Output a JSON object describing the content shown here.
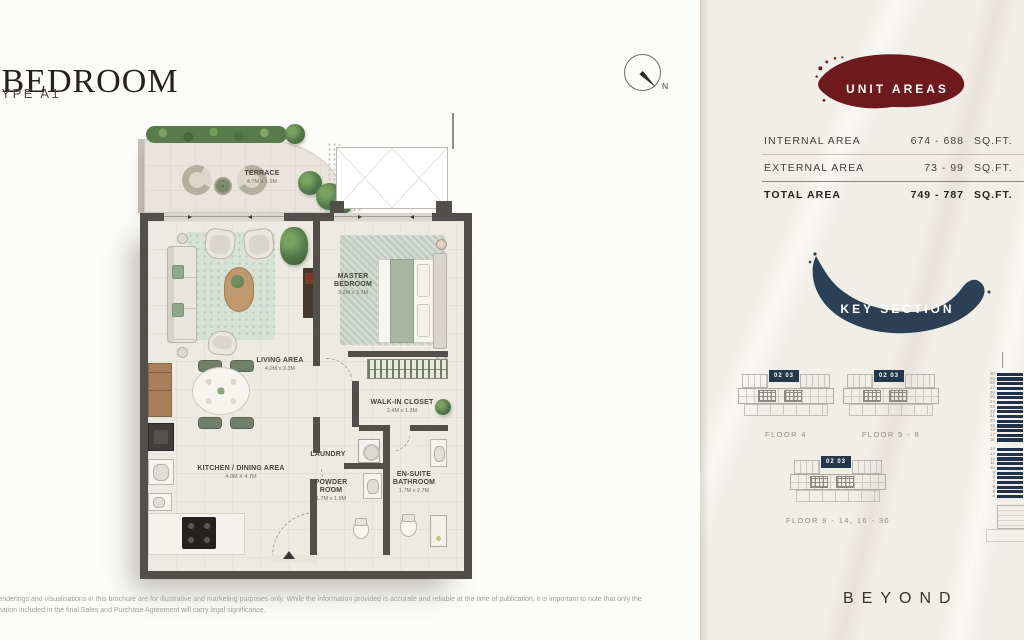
{
  "header": {
    "title": "1 BEDROOM",
    "subtitle": "TYPE A1"
  },
  "compass": {
    "label": "N"
  },
  "floor_plan": {
    "rooms": [
      {
        "name": "TERRACE",
        "dim": "4.7M x 1.9M"
      },
      {
        "name": "LIVING AREA",
        "dim": "4.0M x 3.3M"
      },
      {
        "name": "MASTER BEDROOM",
        "dim": "3.2M x 3.3M"
      },
      {
        "name": "WALK-IN CLOSET",
        "dim": "2.4M x 1.3M"
      },
      {
        "name": "LAUNDRY",
        "dim": ""
      },
      {
        "name": "KITCHEN / DINING AREA",
        "dim": "4.0M X 4.7M"
      },
      {
        "name": "POWDER ROOM",
        "dim": "1.7M x 1.9M"
      },
      {
        "name": "EN-SUITE BATHROOM",
        "dim": "1.7M x 2.7M"
      }
    ]
  },
  "unit_areas": {
    "badge_label": "UNIT AREAS",
    "rows": [
      {
        "label": "INTERNAL AREA",
        "value": "674 - 688",
        "unit": "SQ.FT."
      },
      {
        "label": "EXTERNAL AREA",
        "value": "73 - 99",
        "unit": "SQ.FT."
      },
      {
        "label": "TOTAL AREA",
        "value": "749 - 787",
        "unit": "SQ.FT."
      }
    ]
  },
  "key_section": {
    "badge_label": "KEY SECTION",
    "unit_badge": "02 03",
    "floor_labels": [
      "FLOOR 4",
      "FLOOR 5 - 8",
      "FLOOR 9 - 14, 16 - 30"
    ],
    "elevation": {
      "upper": [
        "30",
        "29",
        "28",
        "27",
        "26",
        "25",
        "24",
        "23",
        "22",
        "21",
        "20",
        "19",
        "18",
        "17",
        "16"
      ],
      "lower": [
        "14",
        "13",
        "12",
        "11",
        "10",
        "9",
        "8",
        "7",
        "6",
        "5",
        "4"
      ]
    }
  },
  "footer": {
    "disclaimer_line1": "renderings and visualisations in this brochure are for illustrative and marketing purposes only. While the information provided is accurate and reliable at the time of publication, it is important to note that only the",
    "disclaimer_line2": "mation included in the final Sales and Purchase Agreement will carry legal significance.",
    "brand": "BEYOND"
  },
  "colors": {
    "accent_maroon": "#6e191c",
    "accent_navy": "#2b4054",
    "wall": "#524f4b"
  }
}
